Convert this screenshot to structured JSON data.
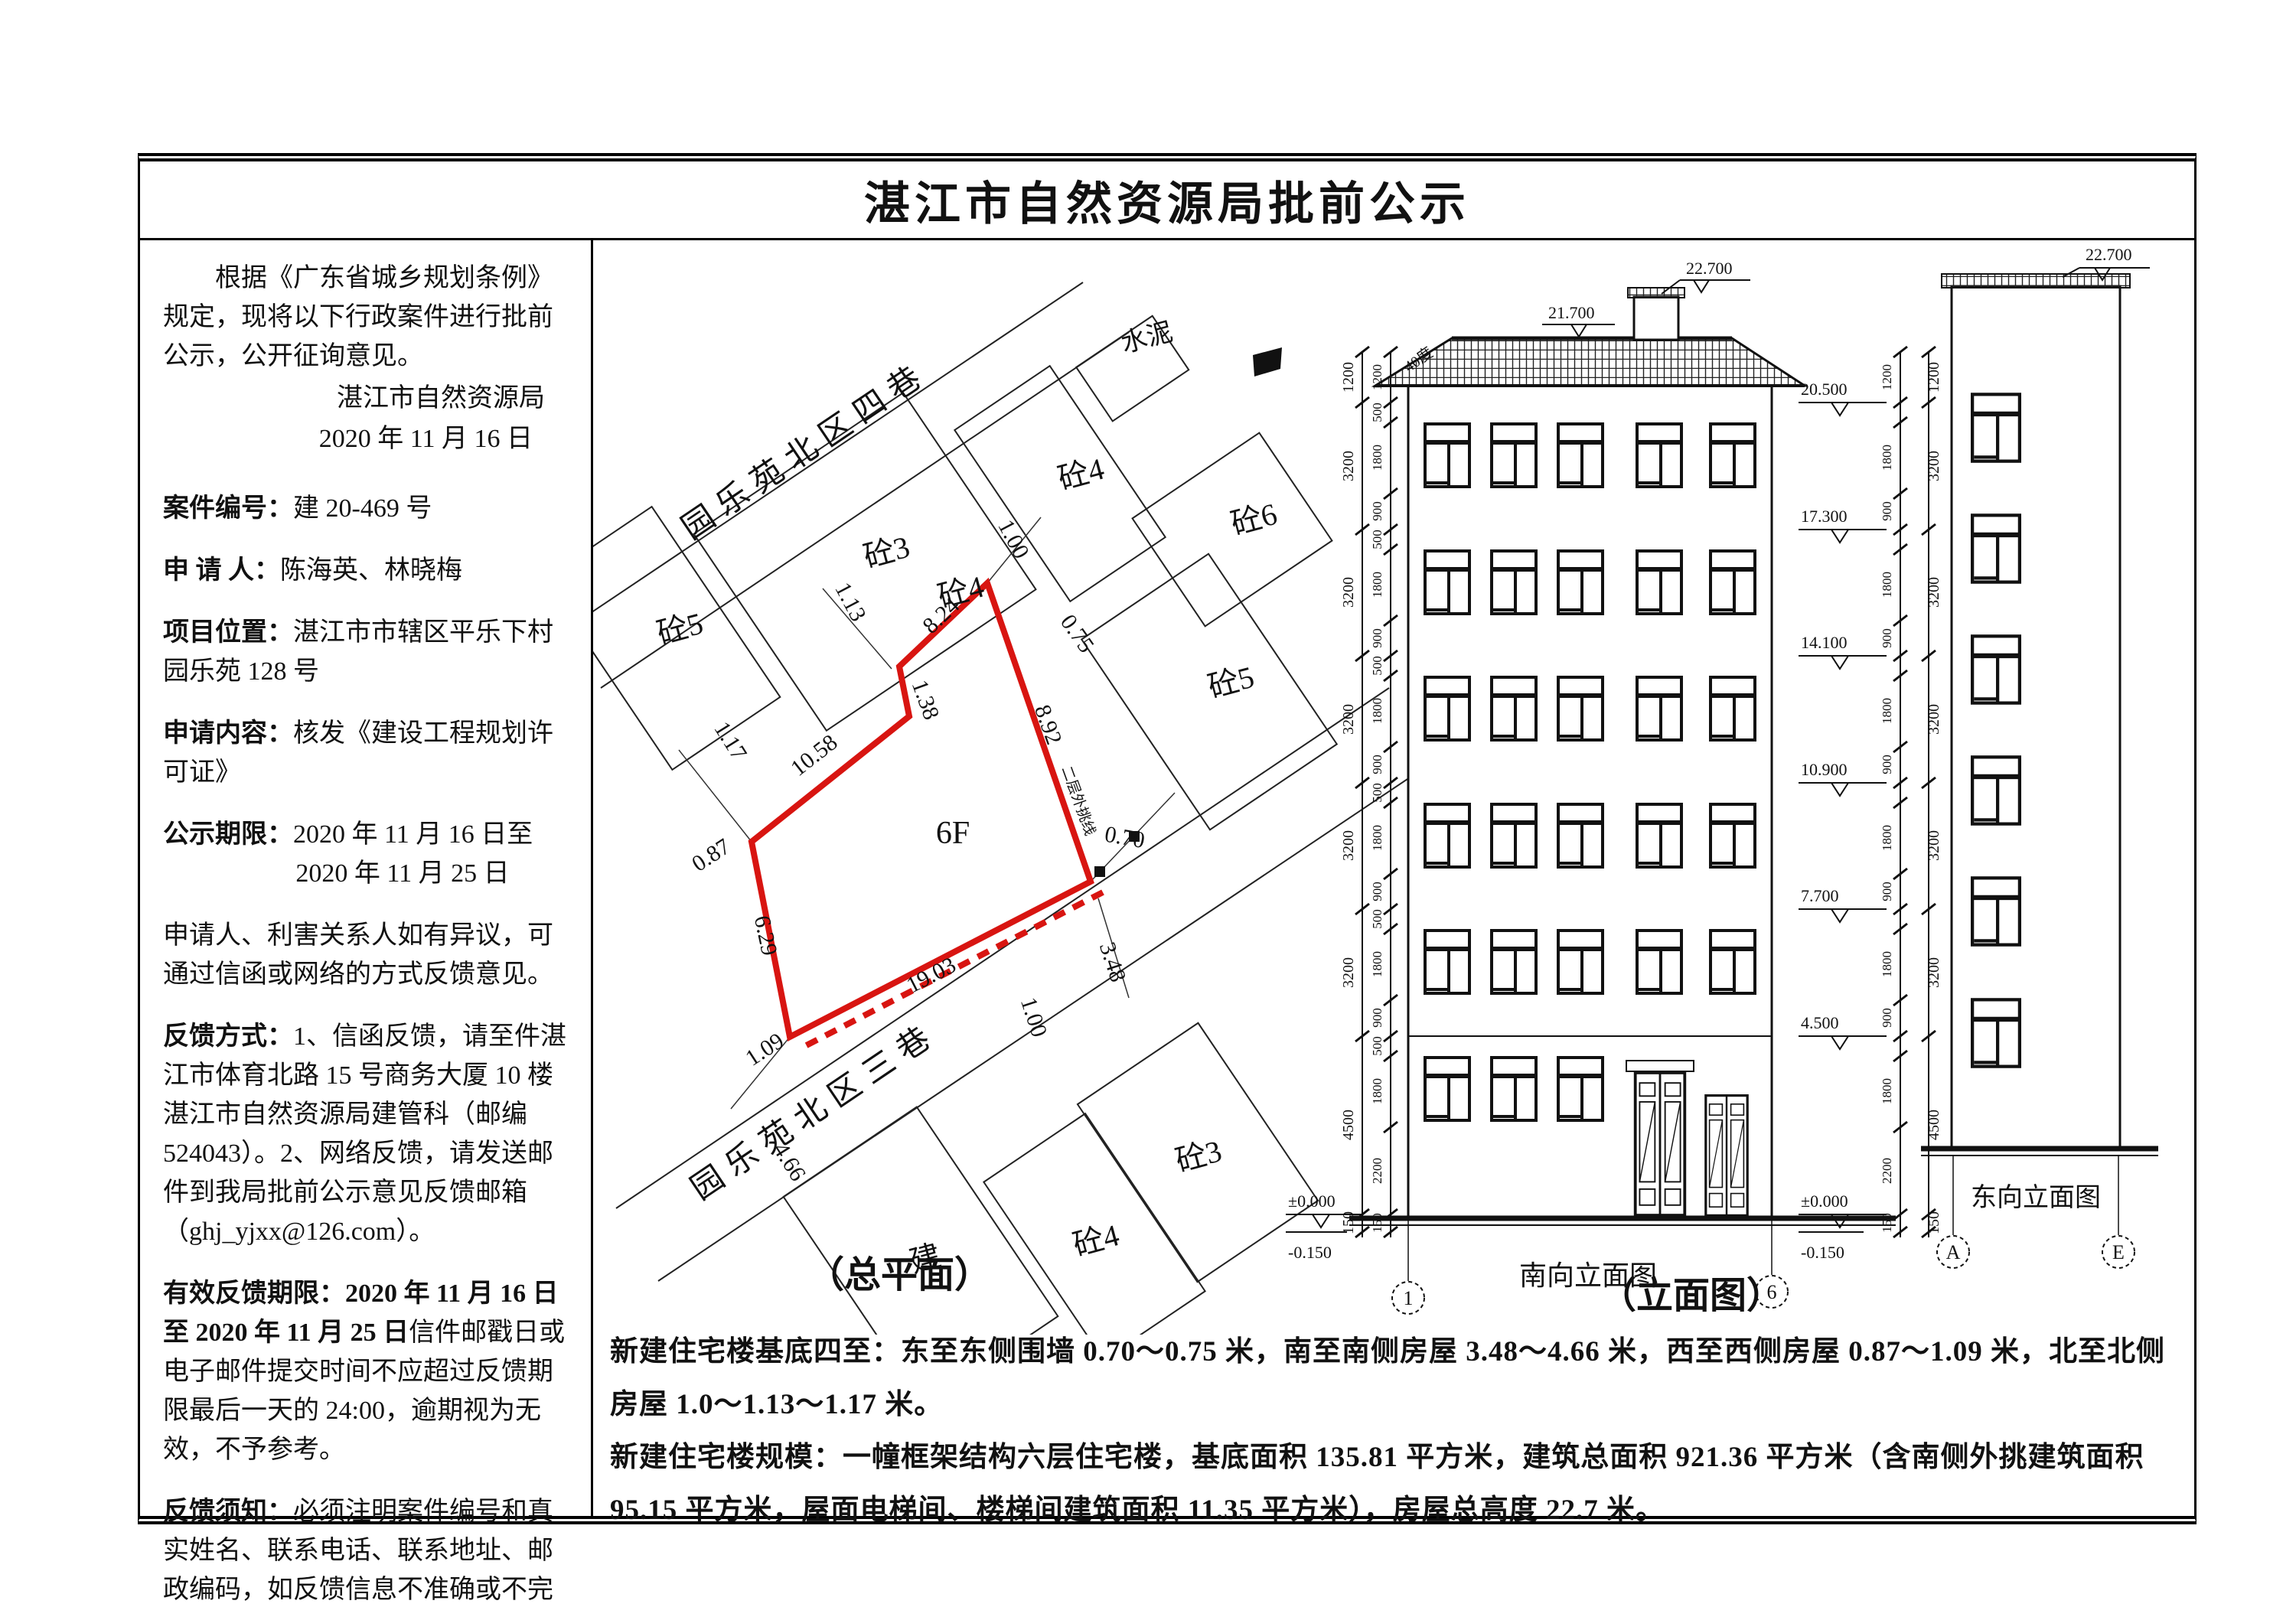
{
  "title": "湛江市自然资源局批前公示",
  "notice": {
    "intro": "根据《广东省城乡规划条例》规定，现将以下行政案件进行批前公示，公开征询意见。",
    "issuer": "湛江市自然资源局",
    "issue_date": "2020 年 11 月 16 日",
    "case_no_label": "案件编号：",
    "case_no": "建 20-469 号",
    "applicant_label": "申 请 人：",
    "applicant": "陈海英、林晓梅",
    "location_label": "项目位置：",
    "location": "湛江市市辖区平乐下村园乐苑 128 号",
    "content_label": "申请内容：",
    "content": "核发《建设工程规划许可证》",
    "period_label": "公示期限：",
    "period_line1": "2020 年 11 月 16 日至",
    "period_line2": "2020 年 11 月 25 日",
    "objection": "申请人、利害关系人如有异议，可通过信函或网络的方式反馈意见。",
    "feedback_label": "反馈方式：",
    "feedback_1": "1、信函反馈，请至件湛江市体育北路 15 号商务大厦 10 楼湛江市自然资源局建管科（邮编 524043）。",
    "feedback_2": "2、网络反馈，请发送邮件到我局批前公示意见反馈邮箱（ghj_yjxx@126.com）。",
    "valid_label": "有效反馈期限：",
    "valid_bold": "2020 年 11 月 16 日至 2020 年 11 月 25 日",
    "valid_rest": "信件邮戳日或电子邮件提交时间不应超过反馈期限最后一天的 24:00，逾期视为无效，不予参考。",
    "note_label": "反馈须知：",
    "note": "必须注明案件编号和真实姓名、联系电话、联系地址、邮政编码，如反馈信息不准确或不完整，导致无法核实有关情况的视为无效。"
  },
  "site_plan": {
    "street_top": "园乐苑北区四巷",
    "street_bottom": "园乐苑北区三巷",
    "plot_floors": "6F",
    "cantilever": "二层外挑线",
    "buildings": [
      "砼5",
      "砼3",
      "砼4",
      "砼4",
      "砼6",
      "砼5",
      "水泥",
      "砼3",
      "砼4",
      "建"
    ],
    "edge_dims": [
      "10.58",
      "1.38",
      "8.24",
      "8.92",
      "19.03",
      "6.29"
    ],
    "clearances": [
      "1.13",
      "1.00",
      "0.75",
      "0.70",
      "3.48",
      "1.00",
      "1.09",
      "0.87",
      "1.17",
      "4.66"
    ],
    "accent_color": "#d81511"
  },
  "elev_south": {
    "caption": "南向立面图",
    "grid_left": "1",
    "grid_right": "6",
    "roof_note": "40度",
    "levels": [
      "22.700",
      "21.700",
      "20.500",
      "17.300",
      "14.100",
      "10.900",
      "7.700",
      "4.500",
      "±0.000",
      "-0.150"
    ],
    "dim_outer": [
      "1200",
      "3200",
      "3200",
      "3200",
      "3200",
      "3200",
      "4500",
      "150"
    ],
    "dim_inner": [
      "1200",
      "500",
      "1800",
      "900",
      "500",
      "1800",
      "900",
      "500",
      "1800",
      "900",
      "500",
      "1800",
      "900",
      "500",
      "1800",
      "900",
      "500",
      "1800",
      "2200",
      "150"
    ]
  },
  "elev_east": {
    "caption": "东向立面图",
    "top_level": "22.700",
    "grid_left": "A",
    "grid_right": "E"
  },
  "drawings": {
    "plan_caption": "（总平面）",
    "elev_caption": "（立面图）"
  },
  "footer": {
    "p1_label": "新建住宅楼基底四至：",
    "p1": "东至东侧围墙 0.70～0.75 米，南至南侧房屋 3.48～4.66 米，西至西侧房屋 0.87～1.09 米，北至北侧房屋 1.0～1.13～1.17 米。",
    "p2_label": "新建住宅楼规模：",
    "p2": "一幢框架结构六层住宅楼，基底面积 135.81 平方米，建筑总面积 921.36 平方米（含南侧外挑建筑面积 95.15 平方米，屋面电梯间、楼梯间建筑面积 11.35 平方米），房屋总高度 22.7 米。"
  }
}
